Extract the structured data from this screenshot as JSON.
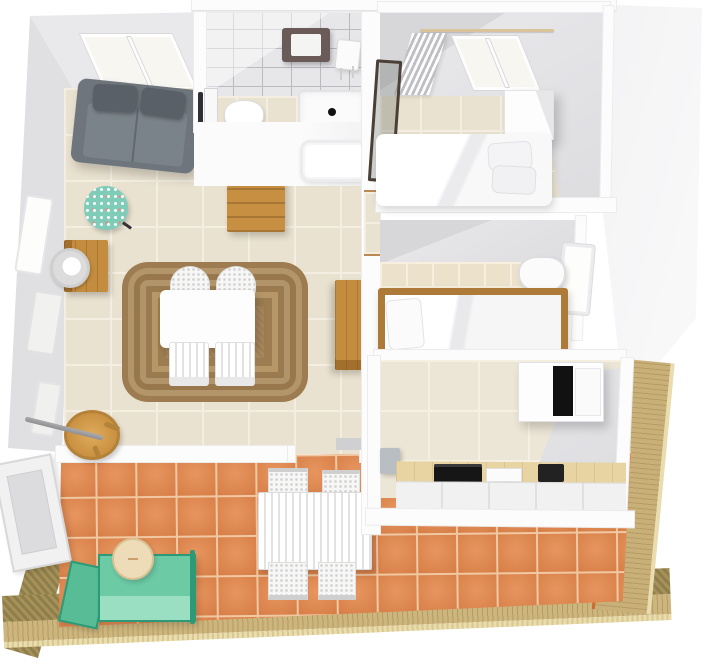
{
  "meta": {
    "description": "Top-down 3D render of an attic apartment floor plan with terrace",
    "view": "top-down-3d",
    "background": "#ffffff"
  },
  "palette": {
    "floor_beige": "#eae2d0",
    "floor_grout": "#f3eee1",
    "bath_tile": "#e7e7ea",
    "bath_grout": "#b8bcc1",
    "terracotta": "#e08a55",
    "terracotta_grout": "#f0c8a2",
    "deck_wood": "#cdb57e",
    "deck_dark": "#8e7e4e",
    "deck_edge_orange": "#cf6a30",
    "roof_gray": "#e6e6e8",
    "slope_gray": "#dddde0",
    "wall_white": "#fcfcfc",
    "sofa_gray": "#6e757c",
    "sofa_cushion": "#596067",
    "rug_brown": "#a8875c",
    "wood": "#c48c3f",
    "mosaic_teal": "#7fccb9",
    "fan_gray": "#dcdcdc",
    "lounger_mint": "#6ccaa5",
    "lounger_frame": "#2d9a77",
    "patio_sand": "#eedcb8",
    "counter_wood": "#e7d4a2",
    "appliance_black": "#161616",
    "metal_gray": "#9c9c9f",
    "mirror_frame": "#6a5a58",
    "bed_white": "#fcfcfc",
    "bed_frame_wood": "#ad7a38"
  },
  "styles": {
    "sofa": "background-color:#6e757c",
    "sofa_cushion": "background-color:#596067",
    "rug": "background-color:#a8875c",
    "mosaic_table": "background-color:#7fccb9",
    "lounger_seat": "background-color:#6ccaa5",
    "lounger_back": "background-color:#58bd97",
    "patio_side_table": "background-color:#eedcb8",
    "counter_top": "background-color:#e7d4a2",
    "oven": "background-color:#161616",
    "cooktop": "background-color:#222222",
    "mirror_cabinet": "background-color:#6a5a58",
    "stick": "background-color:#9c9c9f",
    "round_table": "background-color:#d3994b",
    "gray_cabinet": "background-color:#b9bec2"
  },
  "rooms": [
    {
      "id": "living-room",
      "label": "living room"
    },
    {
      "id": "hallway",
      "label": "hallway"
    },
    {
      "id": "bathroom",
      "label": "bathroom"
    },
    {
      "id": "bedroom-1",
      "label": "bedroom 1"
    },
    {
      "id": "bedroom-2",
      "label": "bedroom 2"
    },
    {
      "id": "kitchen",
      "label": "kitchen"
    },
    {
      "id": "terrace",
      "label": "terrace"
    }
  ],
  "furniture": [
    {
      "id": "sofa",
      "room": "living-room"
    },
    {
      "id": "mosaic-side-table",
      "room": "living-room"
    },
    {
      "id": "crate-side-table",
      "room": "living-room"
    },
    {
      "id": "table-fan",
      "room": "living-room"
    },
    {
      "id": "jute-rug",
      "room": "living-room"
    },
    {
      "id": "dining-table",
      "room": "living-room"
    },
    {
      "id": "wicker-chair",
      "room": "living-room",
      "count": 4
    },
    {
      "id": "round-side-table",
      "room": "living-room"
    },
    {
      "id": "walking-stick",
      "room": "living-room"
    },
    {
      "id": "tall-wardrobe",
      "room": "living-room"
    },
    {
      "id": "chest-of-drawers",
      "room": "hallway"
    },
    {
      "id": "mirror-cabinet",
      "room": "bathroom"
    },
    {
      "id": "washbasin",
      "room": "bathroom"
    },
    {
      "id": "toilet",
      "room": "bathroom"
    },
    {
      "id": "shower",
      "room": "bathroom"
    },
    {
      "id": "bathtub",
      "room": "bathroom"
    },
    {
      "id": "towel-radiator",
      "room": "bathroom"
    },
    {
      "id": "curtain-rod",
      "room": "bedroom-1"
    },
    {
      "id": "curtains",
      "room": "bedroom-1"
    },
    {
      "id": "roof-window",
      "room": "bedroom-1"
    },
    {
      "id": "standing-mirror",
      "room": "bedroom-1"
    },
    {
      "id": "white-cabinet",
      "room": "bedroom-1"
    },
    {
      "id": "double-bed",
      "room": "bedroom-1"
    },
    {
      "id": "single-bed-wood-frame",
      "room": "bedroom-2"
    },
    {
      "id": "desk-chair",
      "room": "bedroom-2"
    },
    {
      "id": "window",
      "room": "bedroom-2"
    },
    {
      "id": "fridge-freezer",
      "room": "kitchen"
    },
    {
      "id": "kitchen-counter",
      "room": "kitchen"
    },
    {
      "id": "oven",
      "room": "kitchen"
    },
    {
      "id": "cooktop",
      "room": "kitchen"
    },
    {
      "id": "wall-cabinet",
      "room": "kitchen"
    },
    {
      "id": "sun-lounger",
      "room": "terrace"
    },
    {
      "id": "patio-side-table",
      "room": "terrace"
    },
    {
      "id": "patio-table",
      "room": "terrace"
    },
    {
      "id": "patio-chair",
      "room": "terrace",
      "count": 4
    },
    {
      "id": "open-door",
      "room": "terrace"
    },
    {
      "id": "wooden-deck-border",
      "room": "terrace"
    }
  ]
}
